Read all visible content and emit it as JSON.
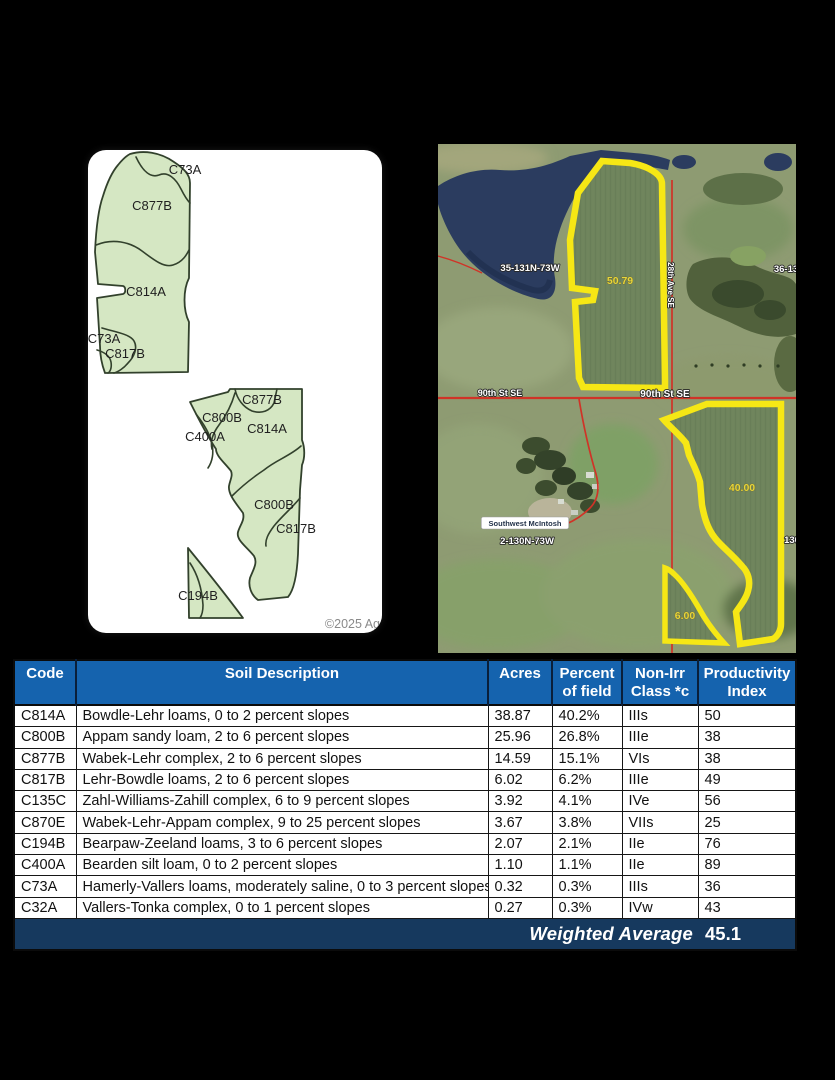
{
  "colors": {
    "header_bg": "#1563AE",
    "footer_bg": "#16395E",
    "soil_fill": "#D5E7C3",
    "soil_outline": "#32412C",
    "field_outline": "#F6E715",
    "road_red": "#D03327",
    "river": "#2B3C5F"
  },
  "soil_map": {
    "copyright": "©2025 Ag",
    "labels": [
      {
        "text": "C73A",
        "x": 97,
        "y": 24
      },
      {
        "text": "C877B",
        "x": 64,
        "y": 60
      },
      {
        "text": "C814A",
        "x": 58,
        "y": 146
      },
      {
        "text": "C73A",
        "x": 16,
        "y": 193
      },
      {
        "text": "C817B",
        "x": 37,
        "y": 208
      },
      {
        "text": "C877B",
        "x": 174,
        "y": 254
      },
      {
        "text": "C800B",
        "x": 134,
        "y": 272
      },
      {
        "text": "C814A",
        "x": 179,
        "y": 283
      },
      {
        "text": "C400A",
        "x": 117,
        "y": 291
      },
      {
        "text": "C800B",
        "x": 186,
        "y": 359
      },
      {
        "text": "C817B",
        "x": 208,
        "y": 383
      },
      {
        "text": "C194B",
        "x": 110,
        "y": 450
      }
    ]
  },
  "aerial": {
    "acre_labels": [
      {
        "text": "50.79",
        "x": 182,
        "y": 140
      },
      {
        "text": "40.00",
        "x": 304,
        "y": 347
      },
      {
        "text": "6.00",
        "x": 247,
        "y": 475
      }
    ],
    "place_labels": [
      {
        "text": "35-131N-73W",
        "x": 92,
        "y": 127,
        "size": 9.5
      },
      {
        "text": "36-13",
        "x": 348,
        "y": 128,
        "size": 9.5
      },
      {
        "text": "90th St SE",
        "x": 62,
        "y": 252,
        "size": 9
      },
      {
        "text": "90th St SE",
        "x": 227,
        "y": 253,
        "size": 10
      },
      {
        "text": "2-130N-73W",
        "x": 89,
        "y": 400,
        "size": 9.5
      },
      {
        "text": "130",
        "x": 354,
        "y": 399,
        "size": 9.5
      }
    ],
    "boxed_label": {
      "text": "Southwest McIntosh",
      "x": 87,
      "y": 382
    },
    "vertical_label": {
      "text": "28th Ave SE",
      "x": 230,
      "y": 141
    }
  },
  "table": {
    "headers": [
      {
        "lines": [
          "Code"
        ]
      },
      {
        "lines": [
          "Soil Description"
        ]
      },
      {
        "lines": [
          "Acres"
        ]
      },
      {
        "lines": [
          "Percent",
          "of field"
        ]
      },
      {
        "lines": [
          "Non-Irr",
          "Class *c"
        ]
      },
      {
        "lines": [
          "Productivity",
          "Index"
        ]
      }
    ],
    "rows": [
      [
        "C814A",
        "Bowdle-Lehr loams, 0 to 2 percent slopes",
        "38.87",
        "40.2%",
        "IIIs",
        "50"
      ],
      [
        "C800B",
        "Appam sandy loam, 2 to 6 percent slopes",
        "25.96",
        "26.8%",
        "IIIe",
        "38"
      ],
      [
        "C877B",
        "Wabek-Lehr complex, 2 to 6 percent slopes",
        "14.59",
        "15.1%",
        "VIs",
        "38"
      ],
      [
        "C817B",
        "Lehr-Bowdle loams, 2 to 6 percent slopes",
        "6.02",
        "6.2%",
        "IIIe",
        "49"
      ],
      [
        "C135C",
        "Zahl-Williams-Zahill complex, 6 to 9 percent slopes",
        "3.92",
        "4.1%",
        "IVe",
        "56"
      ],
      [
        "C870E",
        "Wabek-Lehr-Appam complex, 9 to 25 percent slopes",
        "3.67",
        "3.8%",
        "VIIs",
        "25"
      ],
      [
        "C194B",
        "Bearpaw-Zeeland loams, 3 to 6 percent slopes",
        "2.07",
        "2.1%",
        "IIe",
        "76"
      ],
      [
        "C400A",
        "Bearden silt loam, 0 to 2 percent slopes",
        "1.10",
        "1.1%",
        "IIe",
        "89"
      ],
      [
        "C73A",
        "Hamerly-Vallers loams, moderately saline, 0 to 3 percent slopes",
        "0.32",
        "0.3%",
        "IIIs",
        "36"
      ],
      [
        "C32A",
        "Vallers-Tonka complex, 0 to 1 percent slopes",
        "0.27",
        "0.3%",
        "IVw",
        "43"
      ]
    ],
    "footer_label": "Weighted Average",
    "footer_value": "45.1"
  }
}
